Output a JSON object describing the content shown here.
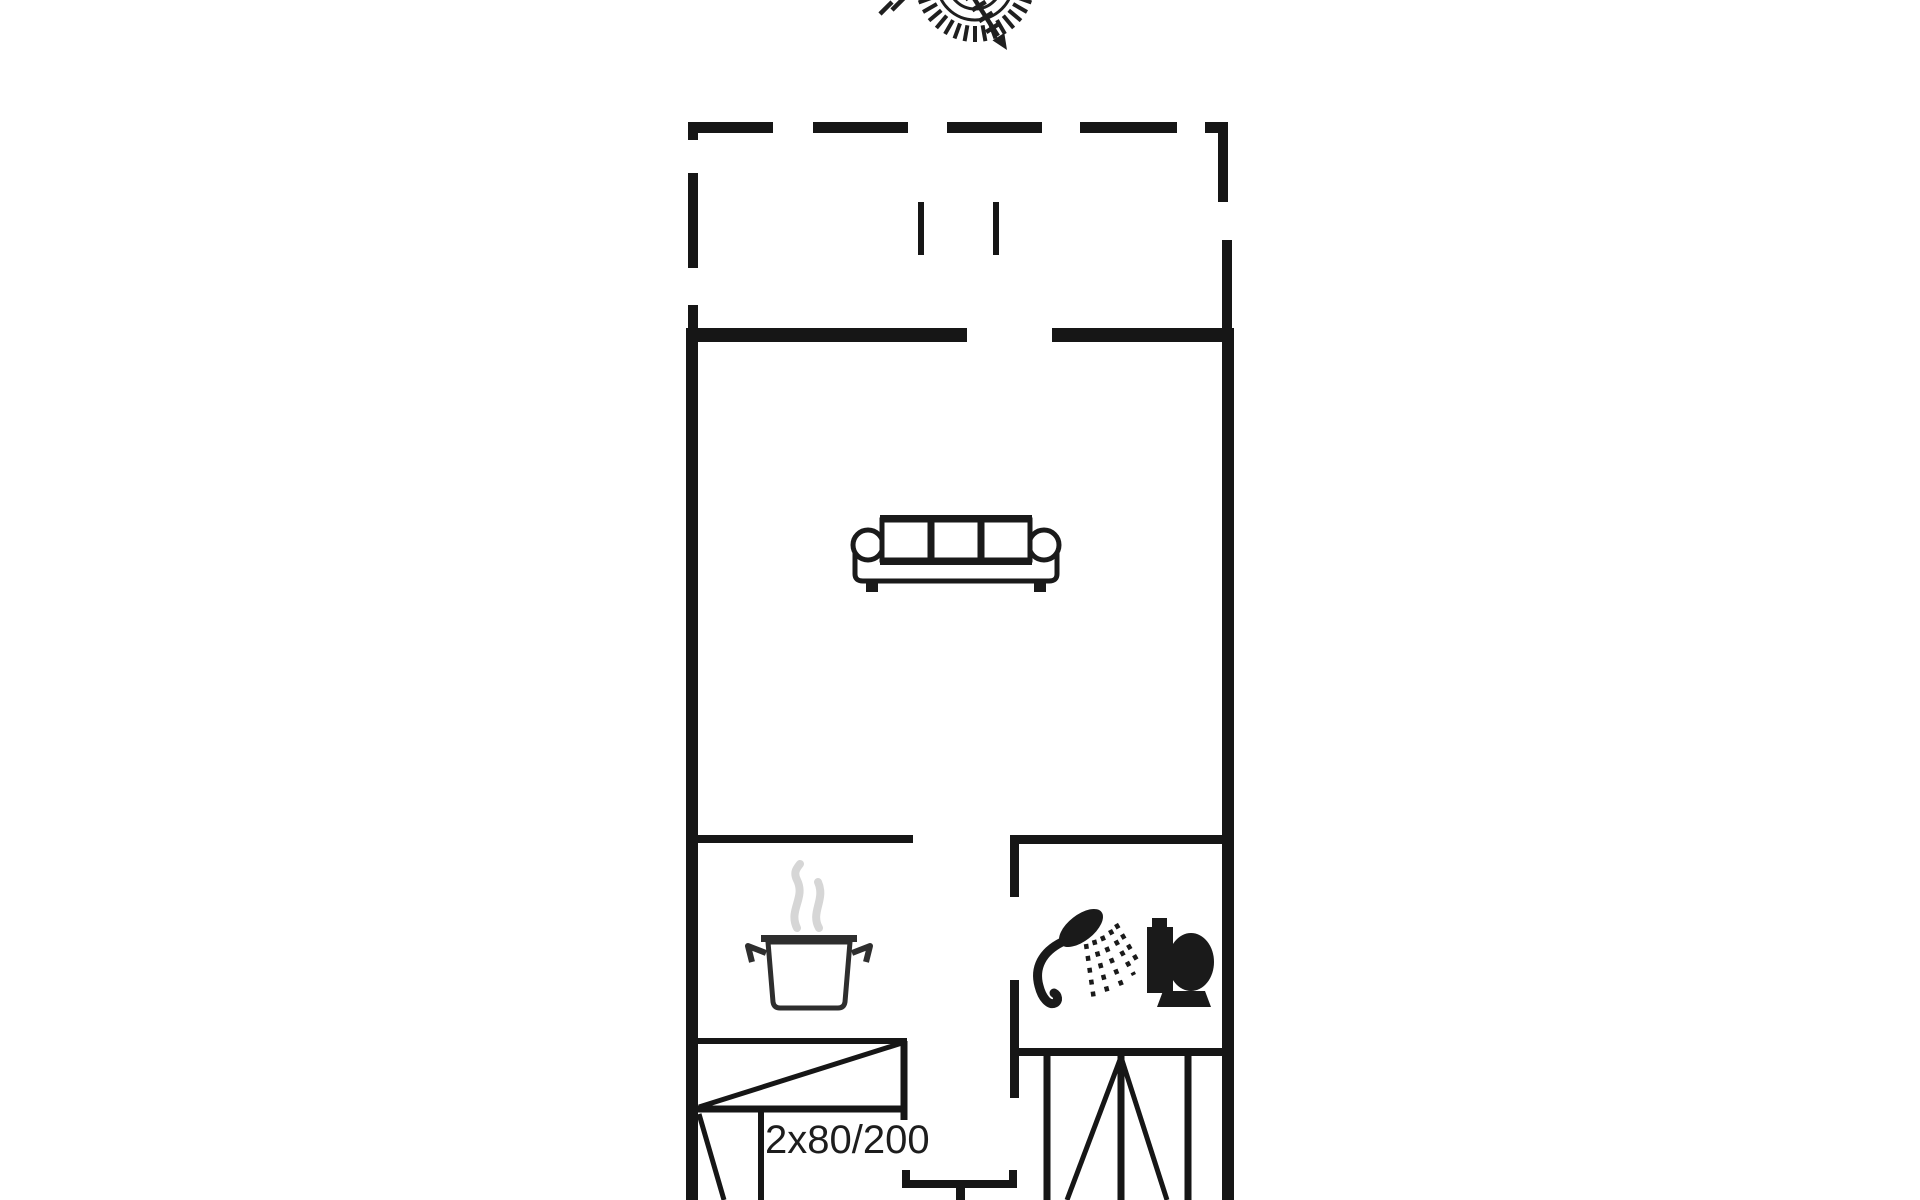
{
  "floorplan": {
    "bed_size_label": "2x80/200",
    "colors": {
      "wall": "#161616",
      "background": "#ffffff",
      "icon": "#1a1a1a",
      "steam": "#d6d6d6"
    },
    "icons": [
      "compass-rose-icon",
      "sofa-icon",
      "cooking-pot-icon",
      "steam-icon",
      "hand-shower-icon",
      "toilet-icon",
      "double-bed-symbol",
      "wardrobe-symbol",
      "door-symbol",
      "terrace-dashed-outline",
      "terrace-door-marks"
    ]
  }
}
